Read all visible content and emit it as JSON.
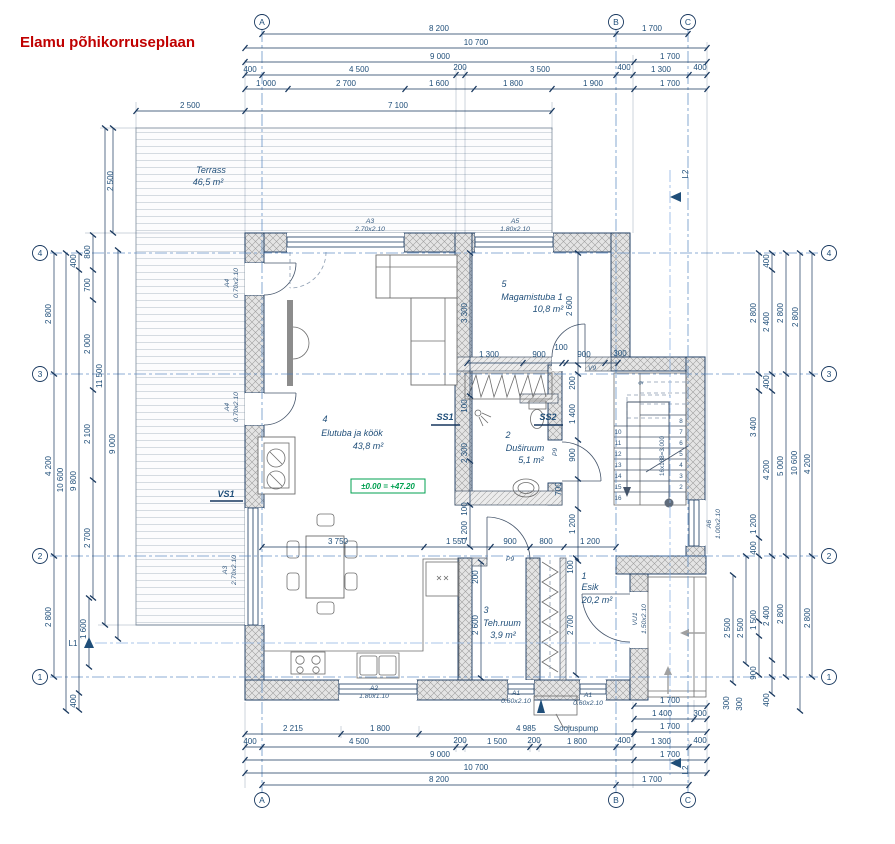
{
  "title": "Elamu põhikorruseplaan",
  "grid": {
    "cols": [
      "A",
      "B",
      "C"
    ],
    "rows": [
      "4",
      "3",
      "2",
      "1"
    ]
  },
  "rooms": {
    "terrass": {
      "name": "Terrass",
      "area": "46,5 m²"
    },
    "r1": {
      "num": "1",
      "name": "Esik",
      "area": "20,2 m²"
    },
    "r2": {
      "num": "2",
      "name": "Duširuum",
      "area": "5,1 m²"
    },
    "r3": {
      "num": "3",
      "name": "Teh.ruum",
      "area": "3,9 m²"
    },
    "r4": {
      "num": "4",
      "name": "Elutuba ja köök",
      "area": "43,8 m²"
    },
    "r5": {
      "num": "5",
      "name": "Magamistuba 1",
      "area": "10,8 m²"
    }
  },
  "openings": {
    "a3t": {
      "code": "A3",
      "size": "2.70x2.10"
    },
    "a5": {
      "code": "A5",
      "size": "1.80x2.10"
    },
    "a4u": {
      "code": "A4",
      "size": "0.70x2.10"
    },
    "a4l": {
      "code": "A4",
      "size": "0.70x2.10"
    },
    "a3l": {
      "code": "A3",
      "size": "2.70x2.10"
    },
    "a2": {
      "code": "A2",
      "size": "1.80x1.10"
    },
    "a1a": {
      "code": "A1",
      "size": "0.60x2.10"
    },
    "a1b": {
      "code": "A1",
      "size": "0.60x2.10"
    },
    "a6": {
      "code": "A6",
      "size": "1.00x2.10"
    },
    "vu1": {
      "code": "VU1",
      "size": "1.50x2.10"
    },
    "v9": "V9",
    "p9a": "P9",
    "p9b": "P9"
  },
  "marks": {
    "vs1": "VS1",
    "ss1": "SS1",
    "ss2": "SS2",
    "l1": "L1",
    "l2a": "L2",
    "l2b": "L2",
    "level": "±0.00 = +47.20",
    "soojuspump": "Soojuspump",
    "stair_formula": "16x188=3.000"
  },
  "stairs": {
    "right_numbers": [
      "8",
      "7",
      "6",
      "5",
      "4",
      "3",
      "2"
    ],
    "left_numbers": [
      "10",
      "11",
      "12",
      "13",
      "14",
      "15",
      "16"
    ],
    "top_number": "9"
  },
  "dims": {
    "top": [
      "8 200",
      "1 700",
      "10 700",
      "9 000",
      "1 700",
      "400",
      "4 500",
      "200",
      "3 500",
      "400",
      "1 300",
      "400",
      "1 000",
      "2 700",
      "1 600",
      "1 800",
      "1 900",
      "1 700",
      "2 500",
      "7 100"
    ],
    "bottom": [
      "2 215",
      "1 800",
      "4 985",
      "400",
      "4 500",
      "200",
      "1 500",
      "200",
      "1 800",
      "400",
      "1 300",
      "400",
      "9 000",
      "1 700",
      "10 700",
      "8 200",
      "1 700",
      "1 700",
      "1 400",
      "300",
      "1 700"
    ],
    "left": [
      "2 500",
      "800",
      "700",
      "2 000",
      "2 100",
      "2 700",
      "2 800",
      "4 200",
      "2 800",
      "10 600",
      "400",
      "9 800",
      "400",
      "11 500",
      "9 000",
      "1 600"
    ],
    "right": [
      "400",
      "2 400",
      "2 800",
      "2 800",
      "2 800",
      "400",
      "3 400",
      "4 200",
      "5 000",
      "10 600",
      "4 200",
      "1 200",
      "400",
      "2 500",
      "2 500",
      "1 500",
      "2 400",
      "2 800",
      "2 800",
      "900",
      "300",
      "300",
      "400"
    ],
    "inner": [
      "3 300",
      "2 600",
      "1 300",
      "900",
      "100",
      "900",
      "300",
      "200",
      "1 400",
      "900",
      "700",
      "1 200",
      "100",
      "2 300",
      "100",
      "1 200",
      "3 750",
      "1 550",
      "900",
      "800",
      "1 200",
      "2 600",
      "200",
      "2 700",
      "100"
    ]
  }
}
